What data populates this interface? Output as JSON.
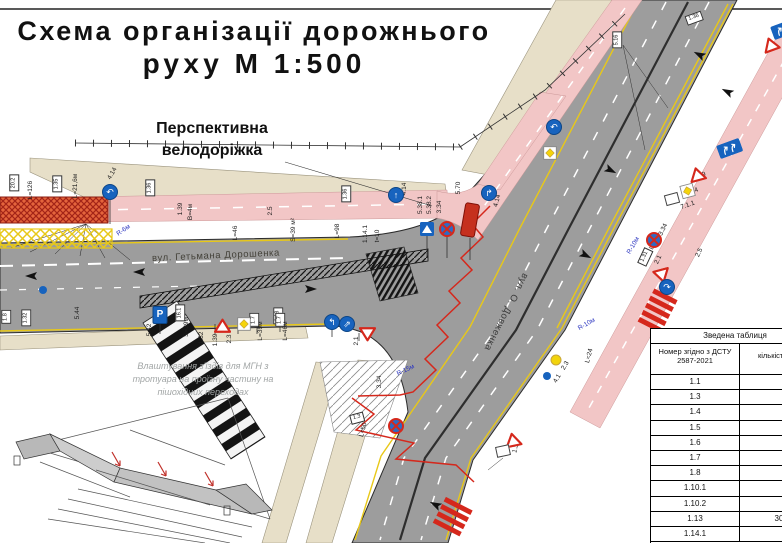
{
  "title": {
    "line1": "Схема організації дорожнього",
    "line2": "руху М 1:500"
  },
  "callouts": {
    "bike_line1": "Перспективна",
    "bike_line2": "велодоріжка",
    "street_main": "вул. Гетьмана Дорошенка",
    "street_cross": "вул. О. Довженка",
    "note_line1": "Влаштування з'їздів для МГН з",
    "note_line2": "тротуара на проїзну частину на",
    "note_line3": "пішохідних переходах"
  },
  "summary_table": {
    "title": "Зведена таблиця",
    "col_number": "Номер згідно з ДСТУ 2587-2021",
    "col_qty": "кількість шт.",
    "rows": [
      {
        "code": "1.1",
        "qty": ""
      },
      {
        "code": "1.3",
        "qty": ""
      },
      {
        "code": "1.4",
        "qty": ""
      },
      {
        "code": "1.5",
        "qty": ""
      },
      {
        "code": "1.6",
        "qty": ""
      },
      {
        "code": "1.7",
        "qty": ""
      },
      {
        "code": "1.8",
        "qty": ""
      },
      {
        "code": "1.10.1",
        "qty": ""
      },
      {
        "code": "1.10.2",
        "qty": ""
      },
      {
        "code": "1.13",
        "qty": "30"
      },
      {
        "code": "1.14.1",
        "qty": ""
      }
    ]
  },
  "map": {
    "colors": {
      "road": "#9d9d9d",
      "sidewalk": "#e7dfc8",
      "bike_lane": "#f2c6c6",
      "marking_yellow": "#e8c818",
      "alert_red": "#d5281c",
      "sign_blue": "#1763be"
    },
    "annotations": [
      {
        "t": "L=21,6м",
        "x": 76,
        "y": 186
      },
      {
        "t": "L=126",
        "x": 31,
        "y": 190
      },
      {
        "t": "4.14",
        "x": 113,
        "y": 174,
        "r": -60
      },
      {
        "t": "4.14",
        "x": 405,
        "y": 189
      },
      {
        "t": "4.14",
        "x": 498,
        "y": 201,
        "r": -75
      },
      {
        "t": "R-6м",
        "x": 124,
        "y": 231,
        "r": -35,
        "c": 1
      },
      {
        "t": "R-10м",
        "x": 587,
        "y": 325,
        "r": -30,
        "c": 1
      },
      {
        "t": "R-10м",
        "x": 634,
        "y": 246,
        "r": -60,
        "c": 1
      },
      {
        "t": "R-15м",
        "x": 406,
        "y": 371,
        "r": -25,
        "c": 1
      },
      {
        "t": "5.70",
        "x": 459,
        "y": 188
      },
      {
        "t": "5.38.1",
        "x": 421,
        "y": 205
      },
      {
        "t": "5.38.2",
        "x": 430,
        "y": 205
      },
      {
        "t": "3.34",
        "x": 440,
        "y": 207
      },
      {
        "t": "3.34",
        "x": 380,
        "y": 382
      },
      {
        "t": "3.34",
        "x": 664,
        "y": 230,
        "r": -65
      },
      {
        "t": "2.3",
        "x": 566,
        "y": 366,
        "r": -60
      },
      {
        "t": "4.1",
        "x": 558,
        "y": 379,
        "r": -60
      },
      {
        "t": "L=24",
        "x": 590,
        "y": 356,
        "r": -75
      },
      {
        "t": "L=22",
        "x": 655,
        "y": 243,
        "r": -65
      },
      {
        "t": "2.1",
        "x": 659,
        "y": 260,
        "r": -65
      },
      {
        "t": "1.19",
        "x": 700,
        "y": 177,
        "r": -20
      },
      {
        "t": "2.4",
        "x": 694,
        "y": 192,
        "r": -20
      },
      {
        "t": "7.1.1",
        "x": 688,
        "y": 206,
        "r": -20
      },
      {
        "t": "1.39",
        "x": 181,
        "y": 209
      },
      {
        "t": "В=4м",
        "x": 191,
        "y": 212
      },
      {
        "t": "2.5",
        "x": 271,
        "y": 211
      },
      {
        "t": "L=46",
        "x": 236,
        "y": 233
      },
      {
        "t": "S=39 м²",
        "x": 294,
        "y": 230
      },
      {
        "t": "L=98",
        "x": 338,
        "y": 231
      },
      {
        "t": "1.14.1",
        "x": 366,
        "y": 234
      },
      {
        "t": "t=10",
        "x": 378,
        "y": 236
      },
      {
        "t": "1.32",
        "x": 202,
        "y": 338
      },
      {
        "t": "1.39",
        "x": 216,
        "y": 340
      },
      {
        "t": "2.3",
        "x": 230,
        "y": 339
      },
      {
        "t": "L=39м",
        "x": 261,
        "y": 331
      },
      {
        "t": "L=46м",
        "x": 286,
        "y": 331
      },
      {
        "t": "S=39м",
        "x": 187,
        "y": 327
      },
      {
        "t": "5.42",
        "x": 150,
        "y": 330
      },
      {
        "t": "5.44",
        "x": 78,
        "y": 313
      },
      {
        "t": "2.1",
        "x": 357,
        "y": 341
      },
      {
        "t": "1.33",
        "x": 517,
        "y": 447,
        "r": -75
      },
      {
        "t": "L=50",
        "x": 364,
        "y": 430,
        "r": -75
      },
      {
        "t": "2.5",
        "x": 700,
        "y": 253,
        "r": -65
      }
    ],
    "plates": [
      {
        "t": "20.2",
        "x": 14,
        "y": 183
      },
      {
        "t": "1.35",
        "x": 57,
        "y": 184
      },
      {
        "t": "1.36",
        "x": 150,
        "y": 188
      },
      {
        "t": "1.36",
        "x": 346,
        "y": 194
      },
      {
        "t": "5.16",
        "x": 617,
        "y": 40
      },
      {
        "t": "1.18",
        "x": 278,
        "y": 316
      },
      {
        "t": "16.1",
        "x": 180,
        "y": 313
      },
      {
        "t": "1.7",
        "x": 254,
        "y": 320
      },
      {
        "t": "1.7",
        "x": 280,
        "y": 320
      },
      {
        "t": "1.8",
        "x": 6,
        "y": 317
      },
      {
        "t": "1.32",
        "x": 26,
        "y": 318
      },
      {
        "t": "1.31",
        "x": 645,
        "y": 257,
        "r": -65
      },
      {
        "t": "1.3",
        "x": 357,
        "y": 418,
        "r": -15
      },
      {
        "t": "1.36",
        "x": 694,
        "y": 18,
        "r": -20
      }
    ],
    "signs": [
      {
        "k": "circle",
        "x": 110,
        "y": 192,
        "g": "↶",
        "name": "pedestrian-bike-path-sign"
      },
      {
        "k": "circle",
        "x": 396,
        "y": 195,
        "g": "↑",
        "name": "pedestrian-bike-path-sign"
      },
      {
        "k": "circle",
        "x": 489,
        "y": 193,
        "g": "↱",
        "name": "pedestrian-bike-path-sign"
      },
      {
        "k": "circle",
        "x": 554,
        "y": 127,
        "g": "↶",
        "name": "mandatory-direction-sign"
      },
      {
        "k": "diamond",
        "x": 543,
        "y": 146,
        "name": "priority-road-sign"
      },
      {
        "k": "ped",
        "x": 427,
        "y": 229,
        "name": "pedestrian-crossing-sign"
      },
      {
        "k": "nostop",
        "x": 447,
        "y": 229,
        "name": "no-stopping-sign"
      },
      {
        "k": "shelter",
        "x": 470,
        "y": 220,
        "r": 10,
        "name": "bus-shelter"
      },
      {
        "k": "park",
        "x": 160,
        "y": 315,
        "g": "P",
        "name": "parking-sign"
      },
      {
        "k": "tri",
        "x": 214,
        "y": 318,
        "name": "warning-sign"
      },
      {
        "k": "diamond",
        "x": 237,
        "y": 317,
        "name": "priority-road-sign"
      },
      {
        "k": "circle",
        "x": 332,
        "y": 322,
        "g": "↰",
        "name": "mandatory-direction-sign"
      },
      {
        "k": "circle",
        "x": 347,
        "y": 324,
        "g": "⇗",
        "name": "mandatory-direction-sign"
      },
      {
        "k": "give",
        "x": 359,
        "y": 327,
        "name": "give-way-sign"
      },
      {
        "k": "board",
        "x": 716,
        "y": 146,
        "r": -20,
        "name": "lane-direction-board"
      },
      {
        "k": "board",
        "x": 770,
        "y": 27,
        "r": -20,
        "name": "lane-direction-board"
      },
      {
        "k": "tri",
        "x": 687,
        "y": 169,
        "r": -15,
        "name": "warning-sign"
      },
      {
        "k": "diamond",
        "x": 679,
        "y": 186,
        "r": -15,
        "name": "end-priority-road-sign"
      },
      {
        "k": "plate0",
        "x": 672,
        "y": 199,
        "r": -15,
        "name": "info-plate"
      },
      {
        "k": "nostop",
        "x": 654,
        "y": 224,
        "name": "no-stopping-sign"
      },
      {
        "k": "give",
        "x": 652,
        "y": 271,
        "r": -15,
        "name": "give-way-sign"
      },
      {
        "k": "circle",
        "x": 667,
        "y": 287,
        "g": "↷",
        "name": "mandatory-direction-sign"
      },
      {
        "k": "tri",
        "x": 760,
        "y": 40,
        "r": -20,
        "name": "warning-sign"
      },
      {
        "k": "nostop",
        "x": 396,
        "y": 394,
        "name": "no-stopping-sign"
      },
      {
        "k": "tri",
        "x": 503,
        "y": 434,
        "r": -12,
        "name": "warning-sign"
      },
      {
        "k": "plate0",
        "x": 503,
        "y": 451,
        "r": -12,
        "name": "info-plate"
      },
      {
        "k": "dot-y",
        "x": 556,
        "y": 360,
        "name": "priority-sign-marker"
      },
      {
        "k": "dot-b",
        "x": 547,
        "y": 376,
        "name": "blue-sign-marker"
      },
      {
        "k": "dot-b",
        "x": 43,
        "y": 290,
        "name": "blue-sign-marker"
      }
    ]
  }
}
